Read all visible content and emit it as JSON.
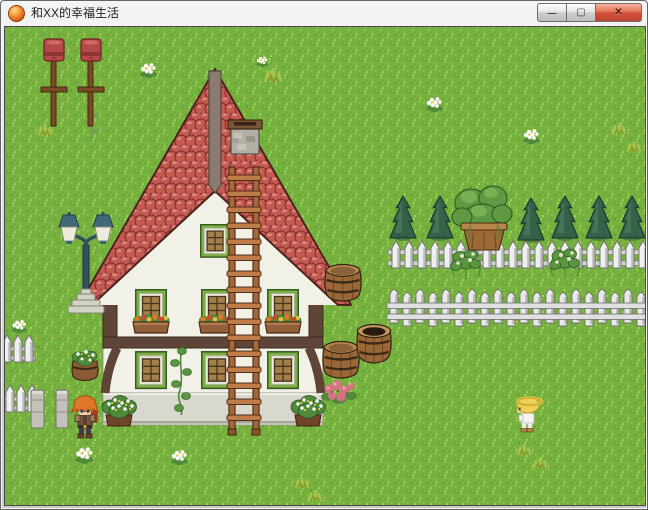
{
  "window": {
    "title": "和XX的幸福生活",
    "icon": "orange-orb",
    "controls": {
      "minimize": "—",
      "maximize": "▢",
      "close": "✕"
    }
  },
  "game": {
    "scene": "grassy-village-yard-with-half-timbered-house",
    "colors": {
      "grass": "#76b140",
      "roof_tile": "#b84a44",
      "wall": "#f2f1e8",
      "timber": "#5f4537",
      "window_frame_green": "#7ab144",
      "fence_white": "#efefef",
      "conifer_green": "#356149",
      "barrel_brown": "#9a6736",
      "lamp_teal": "#33505c",
      "red_post": "#b54848"
    },
    "entities": [
      "red-post",
      "red-post",
      "street-lamp",
      "half-timbered-house",
      "red-tile-roof",
      "ridge-board",
      "stone-chimney",
      "gable-window",
      "upper-windows",
      "lower-windows",
      "window-flower-boxes",
      "climbing-vine",
      "corner-flower-bushes",
      "roof-ladder",
      "wooden-barrel",
      "wooden-barrel",
      "open-barrel",
      "pink-flowers",
      "conifer-trees",
      "potted-tree",
      "upper-picket-fence",
      "lower-picket-fence",
      "fence-vines",
      "left-fence-segments",
      "stone-pillars",
      "barrel-planter",
      "hero-red-hair",
      "child-blonde",
      "white-flowers",
      "grass-tufts"
    ]
  }
}
